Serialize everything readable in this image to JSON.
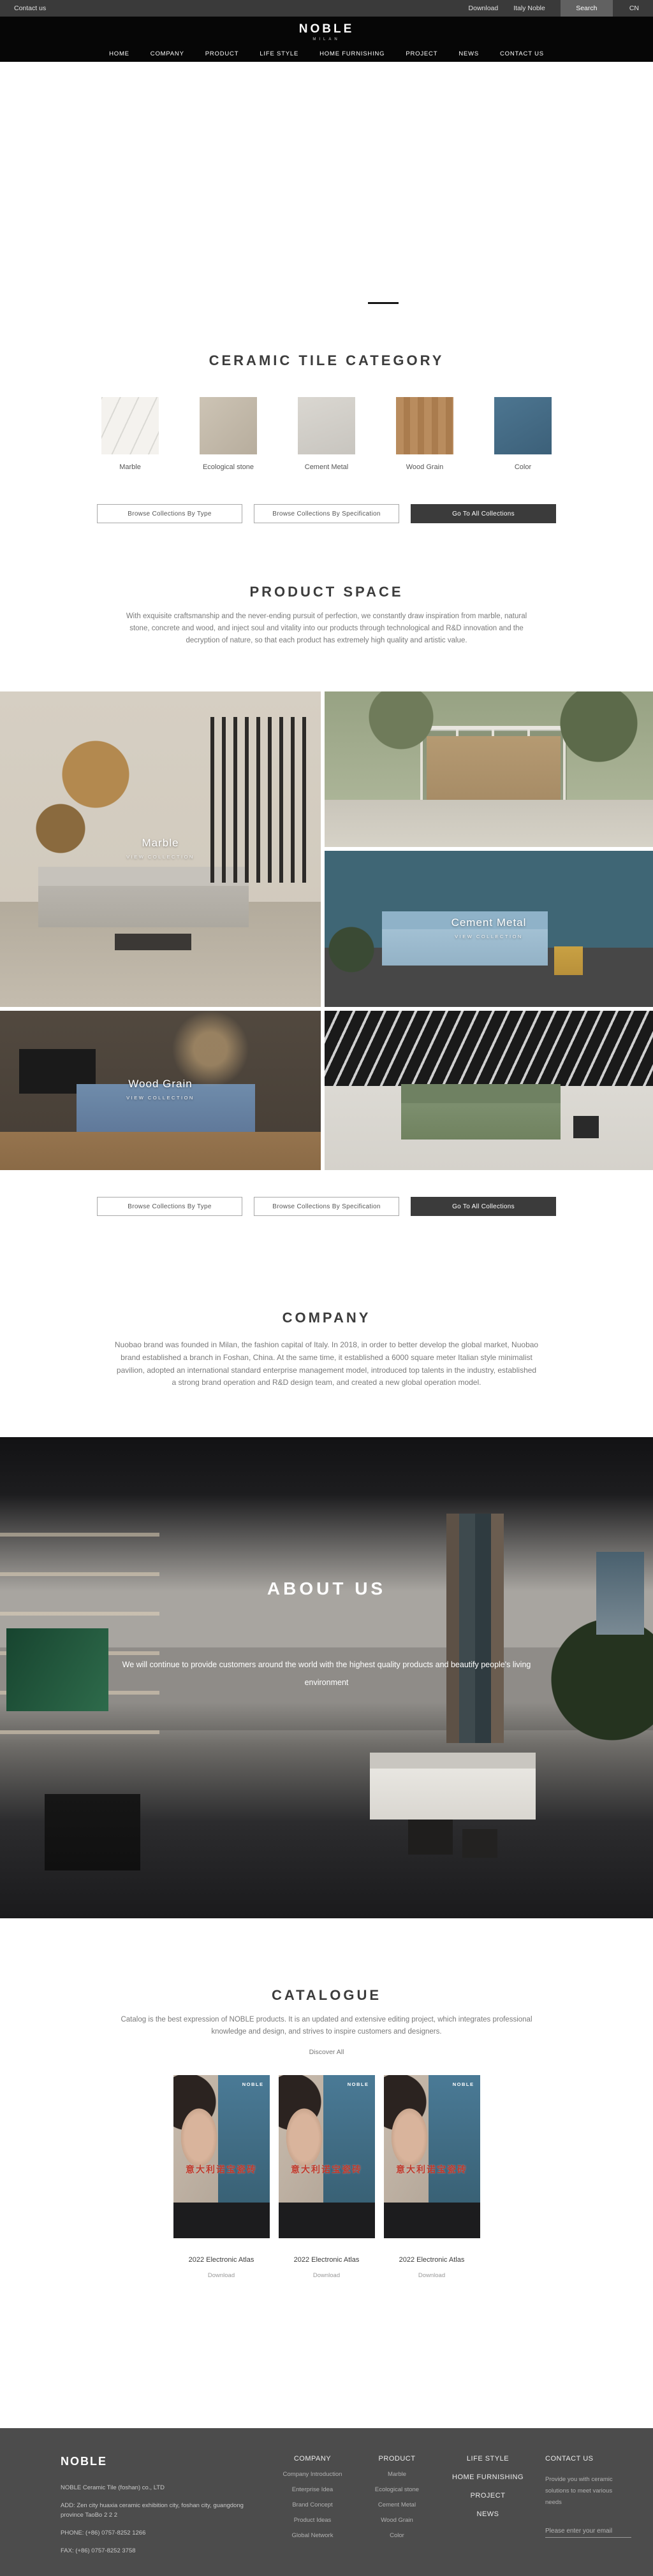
{
  "colors": {
    "accent_red": "#c0392b",
    "dark_button": "#3b3b3b",
    "footer_bg": "#4c4c4c",
    "header_bg": "#060606",
    "topbar_bg": "#3a3a3a"
  },
  "topbar": {
    "contact_us": "Contact us",
    "download": "Download",
    "italy_noble": "Italy Noble",
    "search": "Search",
    "language": "CN"
  },
  "header": {
    "logo": "NOBLE",
    "logo_subtitle": "MILAN",
    "nav": [
      "HOME",
      "COMPANY",
      "PRODUCT",
      "LIFE STYLE",
      "HOME FURNISHING",
      "PROJECT",
      "NEWS",
      "CONTACT US"
    ]
  },
  "hero": {
    "prev_arrow": "❮",
    "next_arrow": "❯",
    "slide_count": 4,
    "active_slide": 4
  },
  "category": {
    "title": "CERAMIC TILE CATEGORY",
    "tiles": [
      {
        "label": "Marble"
      },
      {
        "label": "Ecological stone"
      },
      {
        "label": "Cement Metal"
      },
      {
        "label": "Wood Grain"
      },
      {
        "label": "Color"
      }
    ],
    "buttons": {
      "by_type": "Browse Collections By Type",
      "by_spec": "Browse Collections By Specification",
      "all": "Go To All Collections"
    }
  },
  "product_space": {
    "title": "PRODUCT SPACE",
    "description": "With exquisite craftsmanship and the never-ending pursuit of perfection, we constantly draw inspiration from marble, natural stone, concrete and wood, and inject soul and vitality into our products through technological and R&D innovation and the decryption of nature, so that each product has extremely high quality and artistic value."
  },
  "gallery": {
    "view_collection": "VIEW COLLECTION",
    "labels": {
      "marble": "Marble",
      "cement": "Cement Metal",
      "wood": "Wood Grain"
    }
  },
  "company": {
    "title": "COMPANY",
    "description": "Nuobao brand was founded in Milan, the fashion capital of Italy. In 2018, in order to better develop the global market, Nuobao brand established a branch in Foshan, China. At the same time, it established a 6000 square meter Italian style minimalist pavilion, adopted an international standard enterprise management model, introduced top talents in the industry, established a strong brand operation and R&D design team, and created a new global operation model."
  },
  "about": {
    "title": "ABOUT US",
    "description": "We will continue to provide customers around the world with the highest quality products and beautify people's living environment"
  },
  "catalogue": {
    "title": "CATALOGUE",
    "description": "Catalog is the best expression of NOBLE products. It is an updated and extensive editing project, which integrates professional knowledge and design, and strives to inspire customers and designers.",
    "discover_all": "Discover All",
    "covers": [
      {
        "brand": "NOBLE",
        "cover_title": "意大利诺宝瓷砖",
        "name": "2022 Electronic Atlas",
        "download": "Download"
      },
      {
        "brand": "NOBLE",
        "cover_title": "意大利诺宝瓷砖",
        "name": "2022 Electronic Atlas",
        "download": "Download"
      },
      {
        "brand": "NOBLE",
        "cover_title": "意大利诺宝瓷砖",
        "name": "2022 Electronic Atlas",
        "download": "Download"
      }
    ]
  },
  "footer": {
    "logo": "NOBLE",
    "company_name": "NOBLE Ceramic Tile (foshan) co., LTD",
    "address": "ADD:  Zen city huaxia ceramic exhibition city, foshan city, guangdong province TaoBo 2 2 2",
    "phone": "PHONE:   (+86)  0757-8252 1266",
    "fax": "FAX:   (+86)  0757-8252 3758",
    "columns": {
      "company": {
        "title": "COMPANY",
        "items": [
          "Company Introduction",
          "Enterprise Idea",
          "Brand Concept",
          "Product Ideas",
          "Global Network"
        ]
      },
      "product": {
        "title": "PRODUCT",
        "items": [
          "Marble",
          "Ecological stone",
          "Cement Metal",
          "Wood Grain",
          "Color"
        ]
      },
      "links": [
        "LIFE STYLE",
        "HOME FURNISHING",
        "PROJECT",
        "NEWS"
      ],
      "contact": {
        "title": "CONTACT US",
        "description": "Provide you with ceramic solutions to meet various needs",
        "email_placeholder": "Please enter your email"
      }
    }
  }
}
